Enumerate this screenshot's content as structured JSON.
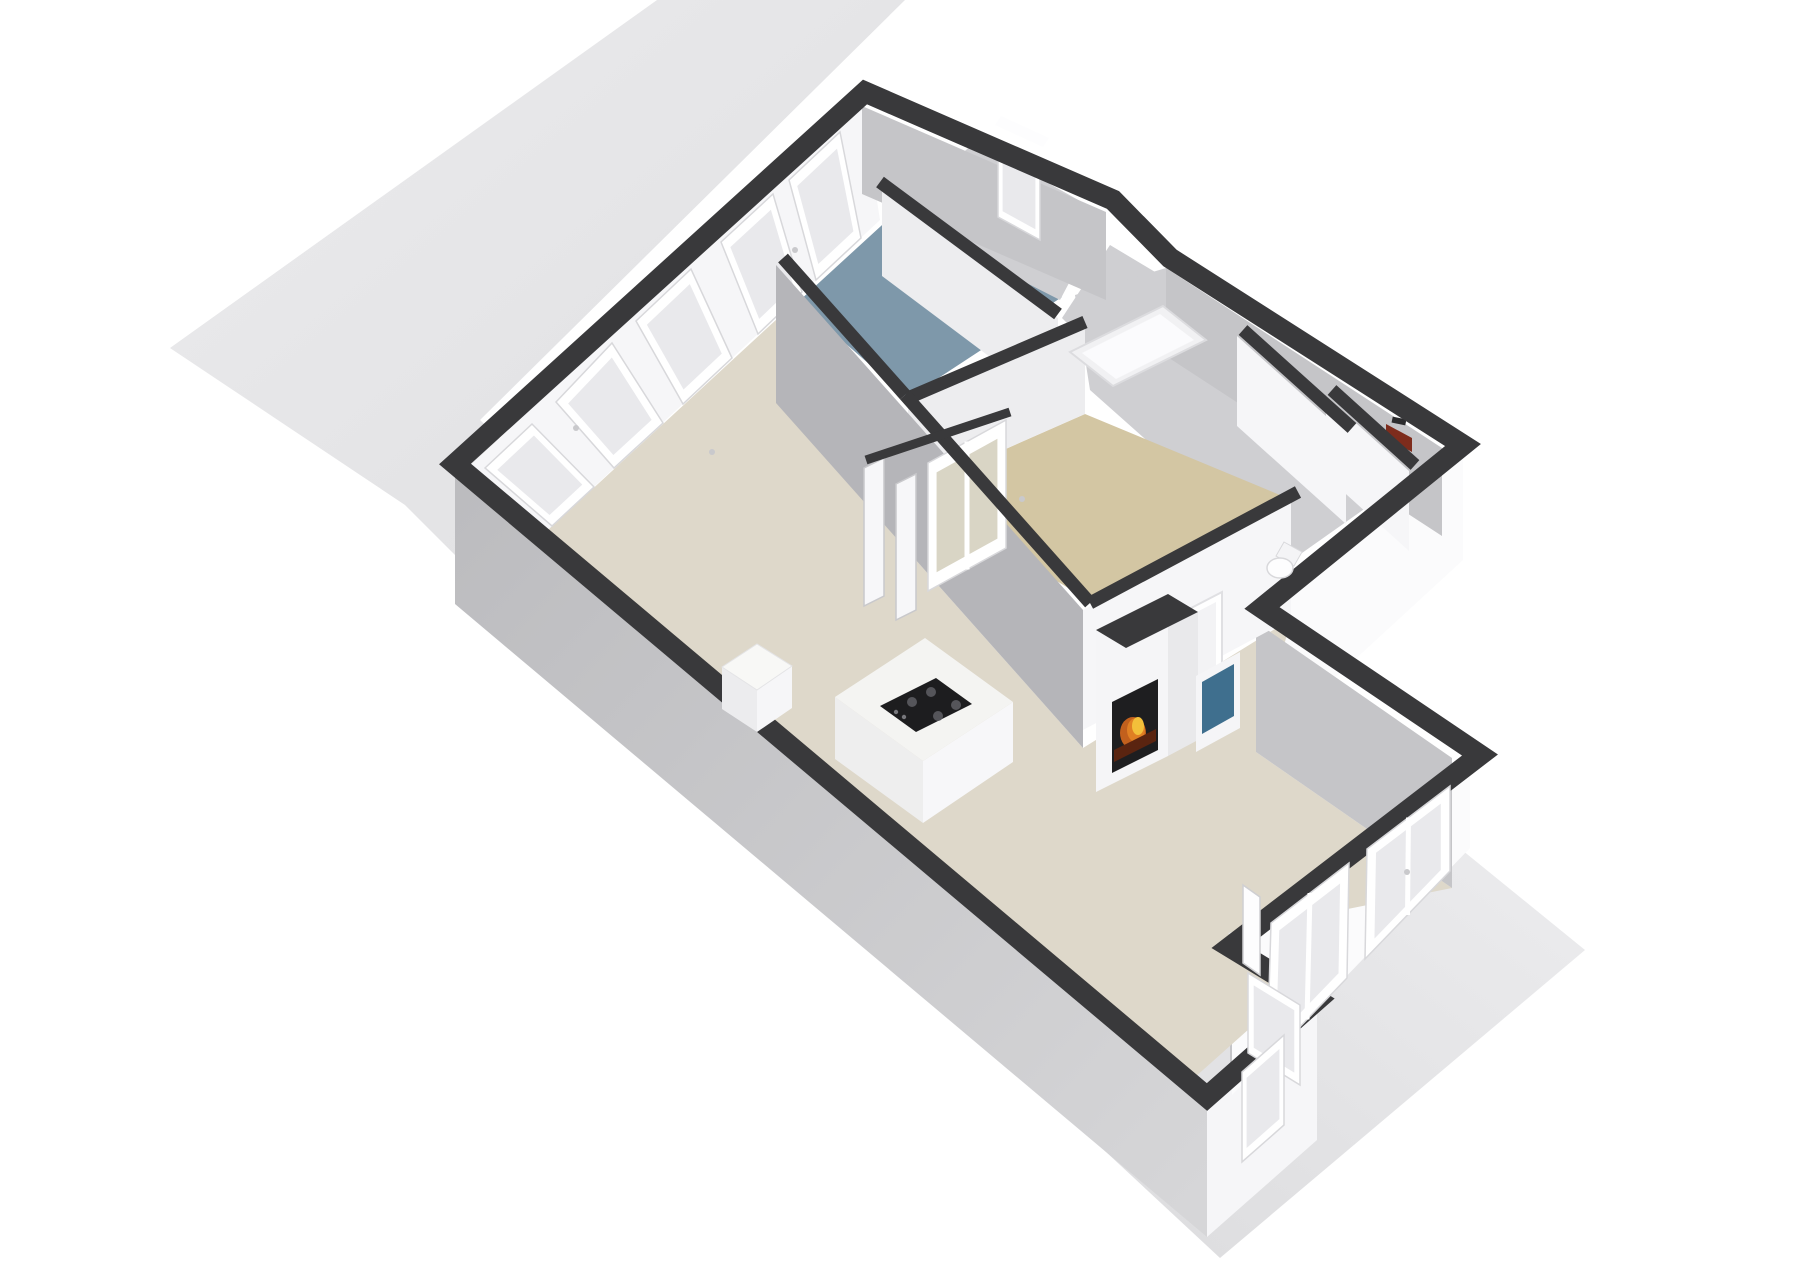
{
  "scene": {
    "type": "3d-floor-plan-render",
    "view": "axonometric-top-down",
    "background": "#ffffff",
    "lot_shape": "rotated rectangle behind house, visible top-left and bottom-right"
  },
  "colors": {
    "background": "#ffffff",
    "lot": "#e7e7e9",
    "lot_edge": "#dededf",
    "wall_top": "#39393b",
    "wall_face_light": "#f6f6f8",
    "wall_face_white": "#fbfbfc",
    "wall_face_mid": "#ededef",
    "wall_face_shadow": "#c5c5c8",
    "wall_face_shadow_dark": "#b5b5b9",
    "floor_living": "#ded8ca",
    "floor_hall": "#d3c6a3",
    "floor_bath": "#7e98aa",
    "floor_room_gray": "#cfcfd2",
    "glass": "#e9e9ec",
    "glass_tinted": "#d9d5c5",
    "frame_white": "#ffffff",
    "frame_edge": "#d8d8db",
    "fire_glow": "#f3c03a",
    "fire_mid": "#e07f23",
    "fire_ember": "#5a2410",
    "fire_box": "#1e1e20",
    "hearth_blue": "#3f6f8e",
    "cooktop_black": "#1d1d1f",
    "burner_gray": "#5a5a5e",
    "accent_red": "#7e2c1c",
    "island_top": "#f4f4f2",
    "island_face": "#eeeeee",
    "tub_white": "#fbfbfd",
    "toilet_white": "#fdfdfe"
  },
  "rooms": [
    {
      "name": "living-kitchen-area",
      "floor": "floor_living"
    },
    {
      "name": "dining-extension",
      "floor": "floor_living"
    },
    {
      "name": "bathroom",
      "floor": "floor_bath"
    },
    {
      "name": "hallway",
      "floor": "floor_hall"
    },
    {
      "name": "bedroom-small",
      "floor": "floor_room_gray"
    },
    {
      "name": "bath-tub-room",
      "floor": "floor_room_gray"
    },
    {
      "name": "utility-rooms",
      "floor": "floor_room_gray"
    }
  ],
  "furniture": [
    {
      "name": "kitchen-island",
      "detail": "white block with black gas cooktop"
    },
    {
      "name": "kitchen-counter",
      "detail": "small white block"
    },
    {
      "name": "fireplace",
      "detail": "white chimney column with burning fire and blue hearth niche"
    },
    {
      "name": "bathtub",
      "detail": "white framed tub seen from above"
    },
    {
      "name": "toilet",
      "detail": "white toilet in small room"
    },
    {
      "name": "wall-unit",
      "detail": "small dark red object on far wall"
    }
  ],
  "openings": {
    "nw_wall_window_groups": 5,
    "bath_ne_window": 1,
    "se_wing_french_doors": 2,
    "notch_door": 1,
    "hall_glass_doors": 1,
    "interior_doorway": 1
  }
}
